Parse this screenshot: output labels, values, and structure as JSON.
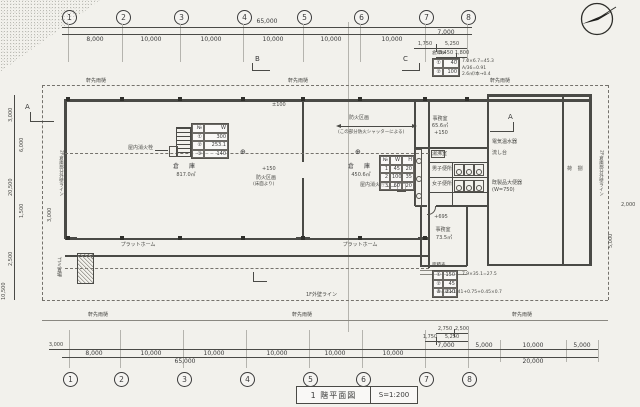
{
  "title_block": {
    "name": "1 階平面図",
    "scale": "S=1:200"
  },
  "grid_labels": [
    "1",
    "2",
    "3",
    "4",
    "5",
    "6",
    "7",
    "8"
  ],
  "dims": {
    "top": {
      "total": "65,000",
      "bays": [
        "8,000",
        "10,000",
        "10,000",
        "10,000",
        "10,000",
        "10,000",
        "7,000"
      ],
      "sub": [
        "1,750",
        "5,250"
      ],
      "sub2": [
        "3,450",
        "1,800"
      ]
    },
    "bottom": {
      "left_small": "3,000",
      "bays": [
        "8,000",
        "10,000",
        "10,000",
        "10,000",
        "10,000",
        "10,000",
        "7,000",
        "5,000",
        "10,000",
        "5,000"
      ],
      "sub": [
        "1,750",
        "5,250"
      ],
      "sub2": [
        "2,750",
        "2,500"
      ],
      "total_left": "65,000",
      "total_right": "20,000"
    },
    "left": {
      "outer": [
        "3,000",
        "20,500",
        "2,500"
      ],
      "inner": [
        "6,000",
        "1,500"
      ],
      "bottom": "10,500",
      "extra": "3,000"
    },
    "right": {
      "v": "5,000",
      "h": "2,000"
    }
  },
  "rooms": {
    "wh1_name": "倉　庫",
    "wh1_area": "817.0㎡",
    "wh2_name": "倉　庫",
    "wh2_area": "450.6㎡",
    "office1_name": "事務室",
    "office1_area": "65.6㎡",
    "office1_level": "+150",
    "office2_name": "事務室",
    "office2_area": "73.5㎡",
    "office2_level": "+695",
    "loading": "荷 捌",
    "platform1": "プラットホーム",
    "platform2": "プラットホーム",
    "garbage": "ゴミ置場",
    "wc1": "湯沸室",
    "wc2": "男子便所",
    "wc3": "女子便所"
  },
  "notes": {
    "hydrant1": "屋内消火栓",
    "hydrant2": "屋内消火栓",
    "firezone1": "防火区画",
    "firezone1_sub": "(この部分防火シャッターによる)",
    "firezone2": "防火区画",
    "firezone2_sub": "(床面より)",
    "eaves": "軒先雨樋",
    "wallnote_l": "2F倉庫部分外壁ライン",
    "wallnote_r": "2F倉庫部分外壁ライン",
    "bottomnote": "1F外壁ライン",
    "fix1": "電気温水器",
    "fix2": "流し台",
    "fix3": "既製品大便器",
    "fix4": "(W=750)",
    "lv1": "±100",
    "lv2": "+150",
    "calc1": "7.0×6.7=45.3",
    "calc2": "A/36=0.91",
    "calc3": "2.6㎡/本→0.4",
    "calc4": "7.9×35.1=27.5",
    "calc5": "A=36×1.41+0.75+0.45×0.7",
    "t1_title": "倉庫№",
    "t4_title": "面積表"
  },
  "markers": {
    "a": "A",
    "b": "B",
    "c": "C"
  },
  "tables": {
    "t1": [
      [
        "№",
        "W"
      ],
      [
        "①",
        "300"
      ],
      [
        "②",
        "253.1"
      ],
      [
        "③",
        "140"
      ]
    ],
    "t2": [
      [
        "№",
        "W",
        "H"
      ],
      [
        "1",
        "45",
        "20"
      ],
      [
        "2",
        "100",
        "35"
      ],
      [
        "3",
        "60",
        "20"
      ]
    ],
    "t3": [
      [
        "①",
        "40"
      ],
      [
        "②",
        "100"
      ]
    ],
    "t4": [
      [
        "①",
        "150"
      ],
      [
        "②",
        "45"
      ],
      [
        "③",
        "210"
      ]
    ]
  }
}
